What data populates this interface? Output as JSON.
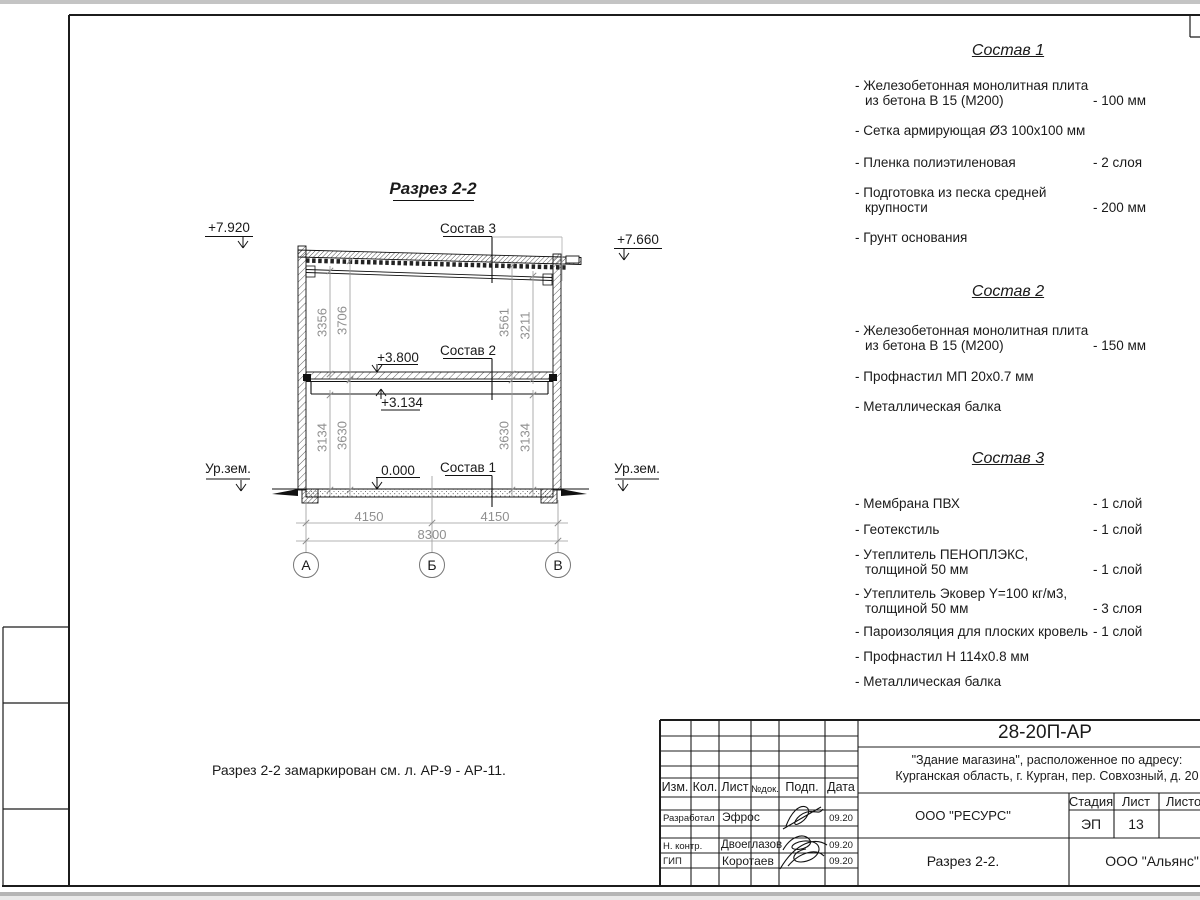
{
  "drawing": {
    "title": "Разрез 2-2",
    "elev_top_left": "+7.920",
    "elev_top_right": "+7.660",
    "elev_floor": "+3.800",
    "elev_beam": "+3.134",
    "elev_zero": "0.000",
    "ground_left": "Ур.зем.",
    "ground_right": "Ур.зем.",
    "label_sostav3": "Состав 3",
    "label_sostav2": "Состав 2",
    "label_sostav1": "Состав 1",
    "dims_v": [
      "3356",
      "3706",
      "3561",
      "3211",
      "3134",
      "3630",
      "3630",
      "3134"
    ],
    "dims_h": [
      "4150",
      "4150",
      "8300"
    ],
    "axes": [
      "А",
      "Б",
      "В"
    ]
  },
  "note": "Разрез 2-2 замаркирован см. л. АР-9 - АР-11.",
  "compositions": [
    {
      "title": "Состав 1",
      "items": [
        {
          "l1": "- Железобетонная  монолитная плита",
          "l2": "из бетона В 15 (М200)",
          "v": "- 100 мм"
        },
        {
          "l1": "- Сетка армирующая Ø3 100х100 мм",
          "l2": "",
          "v": ""
        },
        {
          "l1": "- Пленка полиэтиленовая",
          "l2": "",
          "v": "-  2 слоя"
        },
        {
          "l1": "- Подготовка из песка средней",
          "l2": "крупности",
          "v": "- 200 мм"
        },
        {
          "l1": "- Грунт основания",
          "l2": "",
          "v": ""
        }
      ]
    },
    {
      "title": "Состав 2",
      "items": [
        {
          "l1": "- Железобетонная  монолитная плита",
          "l2": "из бетона В 15 (М200)",
          "v": "- 150 мм"
        },
        {
          "l1": "- Профнастил МП 20х0.7 мм",
          "l2": "",
          "v": ""
        },
        {
          "l1": "- Металлическая балка",
          "l2": "",
          "v": ""
        }
      ]
    },
    {
      "title": "Состав 3",
      "items": [
        {
          "l1": "- Мембрана ПВХ",
          "l2": "",
          "v": "- 1 слой"
        },
        {
          "l1": "- Геотекстиль",
          "l2": "",
          "v": "- 1 слой"
        },
        {
          "l1": "- Утеплитель ПЕНОПЛЭКС,",
          "l2": "толщиной 50 мм",
          "v": "- 1 слой"
        },
        {
          "l1": "- Утеплитель Эковер Y=100 кг/м3,",
          "l2": "толщиной 50 мм",
          "v": "- 3 слоя"
        },
        {
          "l1": "- Пароизоляция для плоских кровель",
          "l2": "",
          "v": "- 1 слой"
        },
        {
          "l1": "- Профнастил Н 114х0.8 мм",
          "l2": "",
          "v": ""
        },
        {
          "l1": "- Металлическая балка",
          "l2": "",
          "v": ""
        }
      ]
    }
  ],
  "title_block": {
    "doc_code": "28-20П-АР",
    "object_line1": "\"Здание магазина\", расположенное по адресу:",
    "object_line2": "Курганская область, г. Курган, пер. Совхозный, д. 20",
    "org_design": "ООО \"РЕСУРС\"",
    "org_customer": "ООО \"Альянс\"",
    "sheet_name": "Разрез 2-2.",
    "stage_label": "Стадия",
    "list_label": "Лист",
    "listov_label": "Листов",
    "stage_value": "ЭП",
    "list_value": "13",
    "col_izm": "Изм.",
    "col_kol": "Кол.",
    "col_list": "Лист",
    "col_ndok": "№док.",
    "col_podp": "Подп.",
    "col_data": "Дата",
    "rows": [
      {
        "role": "Разработал",
        "name": "Эфрос",
        "date": "09.20"
      },
      {
        "role": "Н. контр.",
        "name": "Двоеглазов",
        "date": "09.20"
      },
      {
        "role": "ГИП",
        "name": "Коротаев",
        "date": "09.20"
      }
    ]
  }
}
